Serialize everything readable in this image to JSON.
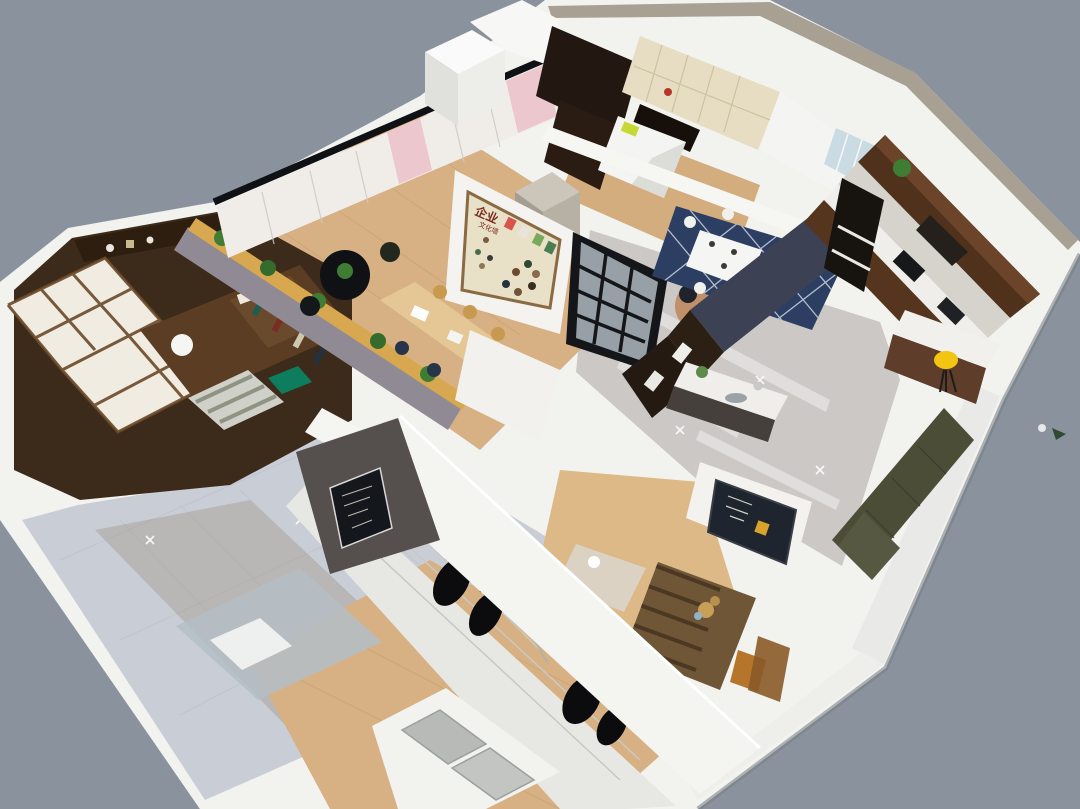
{
  "scene": {
    "description": "Aerial 3D cutaway render of a furnished apartment interior on a plain blue-gray backdrop",
    "poster": {
      "title": "企业",
      "subtitle": "文化墙"
    }
  },
  "palette": {
    "bg": "#8a939d",
    "shell": "#f2f2ef",
    "shell_shadow": "#d8d8d3",
    "outer_band": "#a9a094",
    "tile_left": "#c9cdd6",
    "tile_right": "#cbc8c5",
    "tile_line": "#b6bcc8",
    "wood_floor": "#d7b184",
    "wood_plank": "#c09a64",
    "study_wood": "#3c2a1a",
    "study_shelf": "#2d1e10",
    "shoji_panel": "#f1ece1",
    "shoji_frame": "#6b4a2a",
    "ledge_wood": "#d8a850",
    "ledge_face": "#8f8a93",
    "plant": "#3f7d35",
    "wardrobe_white": "#f0ede8",
    "pink": "#ecc7cd",
    "beam": "#101114",
    "block_white": "#fafafa",
    "block_side": "#e0e0dc",
    "cream": "#e6ddc2",
    "dark_wardrobe": "#221711",
    "poster_board": "#e9e0c8",
    "poster_frame": "#8a6a42",
    "poster_text": "#7a2a20",
    "glass": "#b4bec6",
    "partition": "#14161a",
    "sofa_gray": "#98a2ab",
    "beanbag": "#bf9069",
    "rug_navy": "#2c3f63",
    "lattice": "#cdd4de",
    "tv_slate": "#3c4254",
    "tv_brown": "#2c2015",
    "counter": "#efeeea",
    "cabinet_brown": "#4f311c",
    "cabinet_brown_light": "#6b4429",
    "marble": "#d5d3cc",
    "appliance": "#17181a",
    "stool": "#f3c513",
    "island_brown": "#5e3d2b",
    "sofa_olive": "#4b4d37",
    "rug_kids": "#6f5637",
    "rug_kids_stripe": "#473521",
    "blackboard": "#1f252e",
    "daybed": "#dbd2c4",
    "clothes": "#0c0c0e",
    "closet_white": "#f4f4f1",
    "island_glass": "#b7bab6",
    "accent_wall": "#55504e",
    "coffee_sign": "#14171c",
    "streak": "#9a8f7c",
    "teddy": "#c89f58",
    "lime": "#c6d832",
    "bed_white": "#f4f4f2",
    "cushion": "#0e7d5e",
    "chair_wood": "#c89a50",
    "table_wood": "#e4c794",
    "dining_white": "#f5f5f3",
    "fridge": "#17130e"
  },
  "regions": [
    {
      "name": "study-nook"
    },
    {
      "name": "meeting-area"
    },
    {
      "name": "culture-wall-poster"
    },
    {
      "name": "glass-partition"
    },
    {
      "name": "dining-area"
    },
    {
      "name": "kitchen"
    },
    {
      "name": "living-sofa"
    },
    {
      "name": "kids-corner"
    },
    {
      "name": "walk-in-closet"
    },
    {
      "name": "bathroom"
    },
    {
      "name": "entry-cabinets"
    },
    {
      "name": "bedroom"
    }
  ]
}
